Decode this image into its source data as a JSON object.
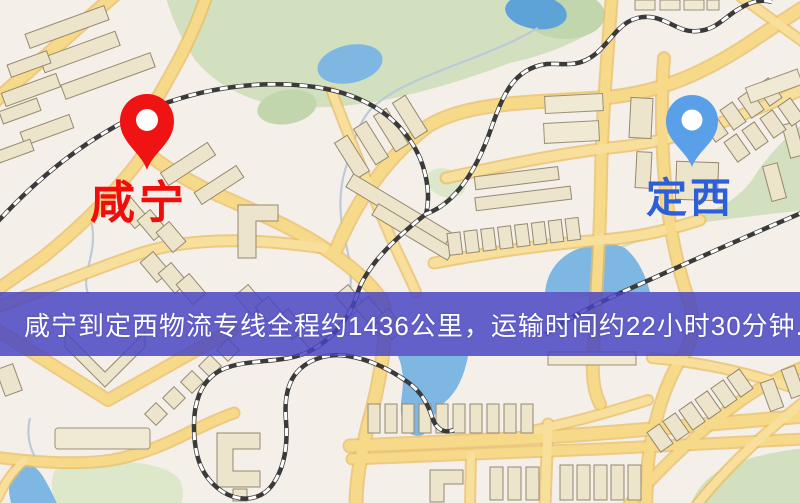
{
  "banner": {
    "text": "咸宁到定西物流专线全程约1436公里，运输时间约22小时30分钟.",
    "route": {
      "origin": "咸宁",
      "destination": "定西",
      "distance": "约1436公里",
      "duration": "约22小时30分钟"
    }
  },
  "map": {
    "origin": {
      "name": "咸宁",
      "pin_color": "#f01313",
      "label_color": "#f20d0d"
    },
    "destination": {
      "name": "定西",
      "pin_color": "#59a0e8",
      "label_color": "#2c5fd8"
    },
    "colors": {
      "background": "#f5efe9",
      "road_fill": "#f7d98a",
      "road_casing": "#e9bd62",
      "building": "#ece4cb",
      "park": "#d3e0bf",
      "water": "#7db7e2",
      "railway": "#3a3a3a",
      "banner_background": "rgba(72,68,194,0.84)",
      "banner_text": "#ffffff"
    }
  }
}
